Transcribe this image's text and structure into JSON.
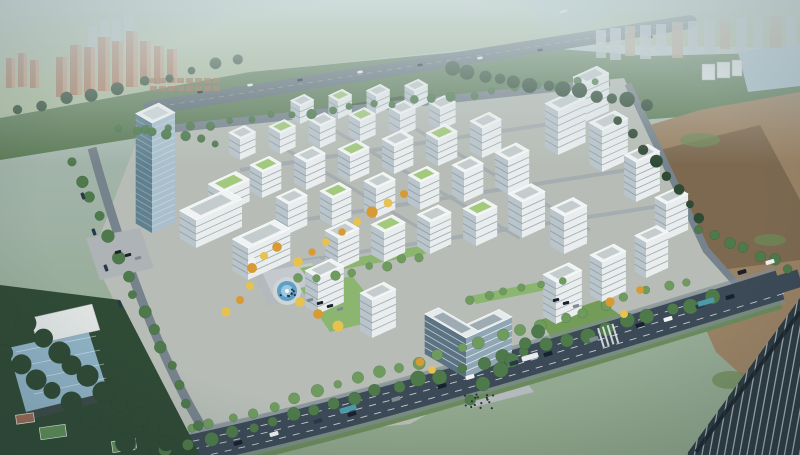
{
  "scene": {
    "kind": "aerial-architectural-rendering",
    "subject": "business-park-campus",
    "width": 800,
    "height": 455
  },
  "colors": {
    "sky_top": "#bfd0d4",
    "sky_mid": "#a3b5ab",
    "sky_low": "#8da488",
    "field_light": "#a9bb9a",
    "greenbelt": "#5d7c57",
    "greenbelt_dark": "#42603f",
    "water": "#9fb8a8",
    "highway": "#5d6d75",
    "dirt": "#9a8264",
    "dirt_dark": "#7d6950",
    "weed": "#6d8a57",
    "factory_roof": "#a7bfca",
    "factory_blue": "#8fb3c6",
    "campus_ground": "#b7bdb6",
    "plaza": "#b3b9bd",
    "lawn": "#8cb56f",
    "lawn_dark": "#729c58",
    "road": "#3c4a57",
    "road_light": "#77838c",
    "verge": "#6b8a5c",
    "forest": "#2f4a35",
    "court": "#5d8f58",
    "roof_white": "#f0f3f3",
    "roof_grey": "#c5cccd",
    "roof_green": "#a3c97c",
    "facade_light": "#e9edee",
    "facade_shade": "#b9c4cb",
    "window_dark": "#55656f",
    "glass_right": "#8fa6b4",
    "glass_left": "#5b7383",
    "tower_glass_right": "#a9c0cc",
    "tower_glass_left": "#60808f",
    "residential": "#a9765a",
    "residential_light": "#c09a7e",
    "rowhouse": "#9b6f52",
    "distant_slab": "#b7c1c5",
    "distant_warm": "#b9a08a",
    "tree_green": "#4e7a4b",
    "tree_light": "#6f9c5e",
    "tree_dark": "#2f4a35",
    "autumn": "#d89a33",
    "autumn_light": "#e7c24f",
    "fountain": "#5c9fc7",
    "person": "#2a3138",
    "fg_glass": "#2c3a42",
    "fg_mullion": "#c9d2d6",
    "car_dark": "#18222e",
    "car_white": "#f0f2f3",
    "car_grey": "#7e8a94",
    "car_navy": "#27384a",
    "bus_teal": "#4a9aa8",
    "bus_white": "#e8ecec"
  },
  "campus": {
    "axis_right": [
      0.92,
      -0.42
    ],
    "axis_left": [
      -0.86,
      -0.5
    ],
    "buildings": [
      {
        "x": 300,
        "y": 124,
        "a": 15,
        "b": 11,
        "h": 18,
        "r": "w"
      },
      {
        "x": 338,
        "y": 119,
        "a": 15,
        "b": 11,
        "h": 18,
        "r": "g"
      },
      {
        "x": 376,
        "y": 114,
        "a": 15,
        "b": 11,
        "h": 18,
        "r": "w"
      },
      {
        "x": 414,
        "y": 109,
        "a": 15,
        "b": 11,
        "h": 18,
        "r": "w"
      },
      {
        "x": 240,
        "y": 160,
        "a": 17,
        "b": 13,
        "h": 21,
        "r": "w"
      },
      {
        "x": 280,
        "y": 154,
        "a": 17,
        "b": 13,
        "h": 21,
        "r": "g"
      },
      {
        "x": 320,
        "y": 148,
        "a": 17,
        "b": 13,
        "h": 22,
        "r": "w"
      },
      {
        "x": 360,
        "y": 142,
        "a": 17,
        "b": 13,
        "h": 21,
        "r": "g"
      },
      {
        "x": 400,
        "y": 136,
        "a": 17,
        "b": 13,
        "h": 22,
        "r": "w"
      },
      {
        "x": 440,
        "y": 130,
        "a": 17,
        "b": 13,
        "h": 21,
        "r": "w"
      },
      {
        "x": 585,
        "y": 122,
        "a": 26,
        "b": 14,
        "h": 38,
        "r": "w"
      },
      {
        "x": 558,
        "y": 155,
        "a": 30,
        "b": 15,
        "h": 44,
        "r": "w"
      },
      {
        "x": 602,
        "y": 172,
        "a": 28,
        "b": 15,
        "h": 42,
        "r": "w"
      },
      {
        "x": 636,
        "y": 202,
        "a": 26,
        "b": 14,
        "h": 40,
        "r": "w"
      },
      {
        "x": 666,
        "y": 240,
        "a": 24,
        "b": 13,
        "h": 36,
        "r": "w"
      },
      {
        "x": 262,
        "y": 198,
        "a": 21,
        "b": 14,
        "h": 26,
        "r": "g"
      },
      {
        "x": 306,
        "y": 190,
        "a": 21,
        "b": 14,
        "h": 28,
        "r": "w"
      },
      {
        "x": 350,
        "y": 182,
        "a": 21,
        "b": 14,
        "h": 26,
        "r": "g"
      },
      {
        "x": 394,
        "y": 174,
        "a": 21,
        "b": 14,
        "h": 28,
        "r": "w"
      },
      {
        "x": 438,
        "y": 166,
        "a": 21,
        "b": 14,
        "h": 26,
        "r": "g"
      },
      {
        "x": 482,
        "y": 158,
        "a": 21,
        "b": 14,
        "h": 30,
        "r": "w"
      },
      {
        "x": 222,
        "y": 214,
        "a": 30,
        "b": 16,
        "h": 22,
        "r": "g"
      },
      {
        "x": 288,
        "y": 234,
        "a": 21,
        "b": 14,
        "h": 30,
        "r": "w"
      },
      {
        "x": 332,
        "y": 226,
        "a": 21,
        "b": 14,
        "h": 28,
        "r": "g"
      },
      {
        "x": 376,
        "y": 218,
        "a": 21,
        "b": 14,
        "h": 30,
        "r": "w"
      },
      {
        "x": 420,
        "y": 210,
        "a": 21,
        "b": 14,
        "h": 28,
        "r": "g"
      },
      {
        "x": 464,
        "y": 202,
        "a": 21,
        "b": 14,
        "h": 30,
        "r": "w"
      },
      {
        "x": 508,
        "y": 194,
        "a": 23,
        "b": 15,
        "h": 34,
        "r": "w"
      },
      {
        "x": 338,
        "y": 270,
        "a": 23,
        "b": 15,
        "h": 32,
        "r": "w"
      },
      {
        "x": 384,
        "y": 262,
        "a": 23,
        "b": 15,
        "h": 30,
        "r": "g"
      },
      {
        "x": 430,
        "y": 254,
        "a": 23,
        "b": 15,
        "h": 32,
        "r": "w"
      },
      {
        "x": 476,
        "y": 246,
        "a": 23,
        "b": 15,
        "h": 30,
        "r": "g"
      },
      {
        "x": 522,
        "y": 238,
        "a": 25,
        "b": 16,
        "h": 36,
        "r": "w"
      },
      {
        "x": 564,
        "y": 254,
        "a": 25,
        "b": 16,
        "h": 38,
        "r": "w"
      },
      {
        "x": 196,
        "y": 248,
        "a": 50,
        "b": 19,
        "h": 28,
        "r": "w"
      },
      {
        "x": 248,
        "y": 280,
        "a": 46,
        "b": 18,
        "h": 32,
        "r": "w"
      },
      {
        "x": 318,
        "y": 314,
        "a": 28,
        "b": 15,
        "h": 36,
        "r": "w"
      },
      {
        "x": 372,
        "y": 338,
        "a": 26,
        "b": 14,
        "h": 38,
        "r": "w"
      },
      {
        "x": 556,
        "y": 324,
        "a": 28,
        "b": 15,
        "h": 42,
        "r": "w"
      },
      {
        "x": 602,
        "y": 302,
        "a": 26,
        "b": 14,
        "h": 40,
        "r": "w"
      },
      {
        "x": 646,
        "y": 278,
        "a": 24,
        "b": 13,
        "h": 36,
        "r": "w"
      },
      {
        "x": 466,
        "y": 378,
        "a": 50,
        "b": 15,
        "h": 40,
        "r": "d",
        "s": "glass"
      },
      {
        "x": 466,
        "y": 378,
        "a": 15,
        "b": 48,
        "h": 40,
        "r": "d",
        "s": "glass"
      },
      {
        "x": 152,
        "y": 233,
        "a": 25,
        "b": 19,
        "h": 110,
        "r": "w",
        "s": "tower"
      }
    ]
  },
  "distant": {
    "residential_left": [
      {
        "x": 56,
        "y": 97,
        "w": 11,
        "h": 40
      },
      {
        "x": 70,
        "y": 95,
        "w": 12,
        "h": 50
      },
      {
        "x": 84,
        "y": 93,
        "w": 11,
        "h": 46
      },
      {
        "x": 98,
        "y": 91,
        "w": 12,
        "h": 54
      },
      {
        "x": 112,
        "y": 89,
        "w": 11,
        "h": 48
      },
      {
        "x": 126,
        "y": 87,
        "w": 12,
        "h": 56
      },
      {
        "x": 140,
        "y": 85,
        "w": 11,
        "h": 44
      },
      {
        "x": 154,
        "y": 84,
        "w": 10,
        "h": 38
      },
      {
        "x": 167,
        "y": 83,
        "w": 10,
        "h": 34
      },
      {
        "x": 6,
        "y": 88,
        "w": 9,
        "h": 30
      },
      {
        "x": 18,
        "y": 87,
        "w": 9,
        "h": 34
      },
      {
        "x": 30,
        "y": 88,
        "w": 9,
        "h": 28
      }
    ],
    "pale_towers": [
      {
        "x": 88,
        "y": 60,
        "w": 9,
        "h": 34
      },
      {
        "x": 100,
        "y": 58,
        "w": 9,
        "h": 38
      },
      {
        "x": 112,
        "y": 56,
        "w": 9,
        "h": 36
      },
      {
        "x": 124,
        "y": 54,
        "w": 9,
        "h": 40
      }
    ],
    "rowhouse_grid": {
      "x0": 150,
      "y0": 86,
      "cols": 8,
      "rows": 2,
      "dx": 9,
      "dy": -8,
      "w": 7,
      "h": 5
    },
    "slabs_right": [
      {
        "x": 596,
        "y": 30,
        "w": 10,
        "h": 28
      },
      {
        "x": 610,
        "y": 28,
        "w": 11,
        "h": 32
      },
      {
        "x": 625,
        "y": 26,
        "w": 10,
        "h": 30
      },
      {
        "x": 640,
        "y": 25,
        "w": 11,
        "h": 34
      },
      {
        "x": 656,
        "y": 24,
        "w": 10,
        "h": 30
      },
      {
        "x": 672,
        "y": 22,
        "w": 11,
        "h": 36
      },
      {
        "x": 688,
        "y": 21,
        "w": 10,
        "h": 30
      },
      {
        "x": 704,
        "y": 20,
        "w": 11,
        "h": 34
      },
      {
        "x": 720,
        "y": 19,
        "w": 10,
        "h": 30
      },
      {
        "x": 736,
        "y": 18,
        "w": 11,
        "h": 34
      },
      {
        "x": 753,
        "y": 17,
        "w": 10,
        "h": 30
      },
      {
        "x": 770,
        "y": 16,
        "w": 11,
        "h": 32
      },
      {
        "x": 786,
        "y": 15,
        "w": 10,
        "h": 30
      }
    ]
  },
  "vegetation": {
    "tree_rows": [
      {
        "x1": 168,
        "y1": 451,
        "x2": 712,
        "y2": 299,
        "n": 27,
        "r": 6,
        "c": "tree_green"
      },
      {
        "x1": 190,
        "y1": 430,
        "x2": 688,
        "y2": 280,
        "n": 25,
        "r": 5,
        "c": "tree_light"
      },
      {
        "x1": 148,
        "y1": 131,
        "x2": 596,
        "y2": 80,
        "n": 23,
        "r": 4,
        "c": "tree_green"
      },
      {
        "x1": 452,
        "y1": 70,
        "x2": 644,
        "y2": 104,
        "n": 13,
        "r": 6,
        "c": "tree_dark"
      },
      {
        "x1": 74,
        "y1": 162,
        "x2": 196,
        "y2": 424,
        "n": 15,
        "r": 5,
        "c": "tree_green"
      },
      {
        "x1": 12,
        "y1": 310,
        "x2": 168,
        "y2": 444,
        "n": 11,
        "r": 9,
        "c": "tree_dark"
      },
      {
        "x1": 2,
        "y1": 352,
        "x2": 140,
        "y2": 455,
        "n": 9,
        "r": 10,
        "c": "tree_dark"
      },
      {
        "x1": 120,
        "y1": 128,
        "x2": 214,
        "y2": 142,
        "n": 7,
        "r": 4,
        "c": "tree_green"
      },
      {
        "x1": 620,
        "y1": 120,
        "x2": 700,
        "y2": 220,
        "n": 8,
        "r": 5,
        "c": "tree_dark"
      },
      {
        "x1": 700,
        "y1": 228,
        "x2": 790,
        "y2": 268,
        "n": 7,
        "r": 5,
        "c": "tree_green"
      },
      {
        "x1": 240,
        "y1": 60,
        "x2": 20,
        "y2": 110,
        "n": 10,
        "r": 5,
        "c": "tree_dark"
      },
      {
        "x1": 540,
        "y1": 330,
        "x2": 470,
        "y2": 400,
        "n": 6,
        "r": 6,
        "c": "tree_green"
      },
      {
        "x1": 300,
        "y1": 280,
        "x2": 420,
        "y2": 258,
        "n": 8,
        "r": 4,
        "c": "tree_light"
      },
      {
        "x1": 470,
        "y1": 300,
        "x2": 560,
        "y2": 282,
        "n": 6,
        "r": 4,
        "c": "tree_light"
      }
    ],
    "autumn_trees": [
      [
        252,
        268
      ],
      [
        264,
        256
      ],
      [
        277,
        247
      ],
      [
        298,
        262
      ],
      [
        312,
        252
      ],
      [
        326,
        242
      ],
      [
        342,
        232
      ],
      [
        357,
        222
      ],
      [
        372,
        212
      ],
      [
        388,
        203
      ],
      [
        404,
        194
      ],
      [
        250,
        286
      ],
      [
        240,
        300
      ],
      [
        300,
        302
      ],
      [
        318,
        314
      ],
      [
        338,
        326
      ],
      [
        420,
        362
      ],
      [
        432,
        370
      ],
      [
        610,
        302
      ],
      [
        624,
        314
      ],
      [
        640,
        290
      ],
      [
        226,
        312
      ]
    ]
  },
  "traffic": {
    "arterial_angle": -16,
    "cars_arterial": [
      [
        238,
        443,
        "car_dark"
      ],
      [
        274,
        434,
        "car_white"
      ],
      [
        318,
        421,
        "car_navy"
      ],
      [
        352,
        414,
        "car_dark"
      ],
      [
        396,
        399,
        "car_grey"
      ],
      [
        442,
        386,
        "car_dark"
      ],
      [
        470,
        377,
        "car_white"
      ],
      [
        514,
        363,
        "car_navy"
      ],
      [
        548,
        354,
        "car_dark"
      ],
      [
        594,
        339,
        "car_grey"
      ],
      [
        640,
        325,
        "car_dark"
      ],
      [
        668,
        319,
        "car_white"
      ],
      [
        700,
        306,
        "car_navy"
      ],
      [
        730,
        297,
        "car_dark"
      ],
      [
        742,
        272,
        "car_dark"
      ],
      [
        770,
        262,
        "car_white"
      ]
    ],
    "buses_arterial": [
      [
        348,
        409,
        "bus_teal"
      ],
      [
        530,
        357,
        "bus_white"
      ],
      [
        706,
        302,
        "bus_teal"
      ]
    ],
    "cars_highway": [
      [
        200,
        92
      ],
      [
        250,
        85
      ],
      [
        300,
        80
      ],
      [
        360,
        72
      ],
      [
        420,
        65
      ],
      [
        480,
        58
      ],
      [
        540,
        50
      ],
      [
        600,
        43
      ],
      [
        650,
        37
      ]
    ],
    "cars_left_road": [
      [
        83,
        196
      ],
      [
        94,
        232
      ],
      [
        106,
        268
      ],
      [
        120,
        304
      ]
    ],
    "parked": [
      [
        310,
        300
      ],
      [
        320,
        303
      ],
      [
        330,
        306
      ],
      [
        340,
        309
      ],
      [
        556,
        300
      ],
      [
        566,
        303
      ],
      [
        576,
        306
      ],
      [
        118,
        252
      ],
      [
        128,
        255
      ],
      [
        138,
        258
      ]
    ]
  },
  "people_clusters": [
    {
      "cx": 480,
      "cy": 400,
      "n": 16,
      "spread": 30
    },
    {
      "cx": 287,
      "cy": 293,
      "n": 8,
      "spread": 16
    }
  ]
}
